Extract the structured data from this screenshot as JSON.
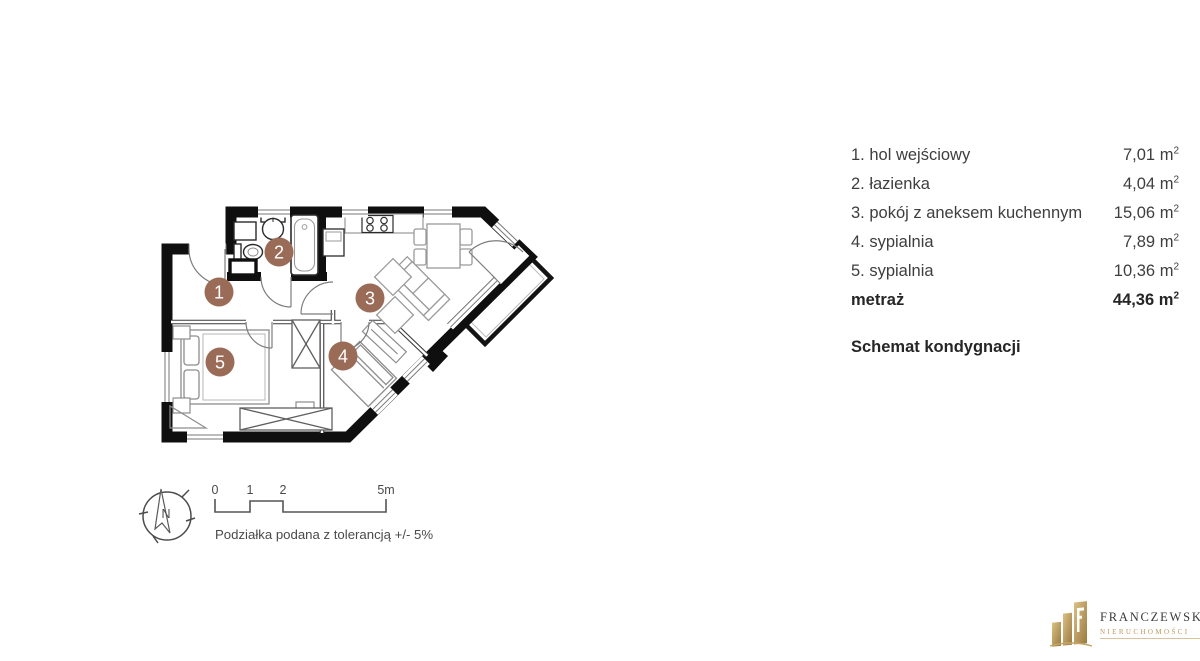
{
  "legend": {
    "rows": [
      {
        "label": "1. hol wejściowy",
        "area": "7,01"
      },
      {
        "label": "2. łazienka",
        "area": "4,04"
      },
      {
        "label": "3. pokój z aneksem kuchennym",
        "area": "15,06"
      },
      {
        "label": "4. sypialnia",
        "area": "7,89"
      },
      {
        "label": "5. sypialnia",
        "area": "10,36"
      }
    ],
    "unit": "m",
    "unit_sup": "2",
    "total": {
      "label": "metraż",
      "area": "44,36"
    },
    "schema_heading": "Schemat kondygnacji"
  },
  "plan": {
    "rooms": [
      "1",
      "2",
      "3",
      "4",
      "5"
    ],
    "marker_color": "#9a6c58",
    "wall_color": "#0f0f0f"
  },
  "compass": {
    "north_label": "N"
  },
  "scalebar": {
    "tick0": "0",
    "tick1": "1",
    "tick2": "2",
    "tick5": "5m",
    "note": "Podziałka podana z tolerancją +/- 5%"
  },
  "logo": {
    "name": "FRANCZEWSKA",
    "subtitle": "NIERUCHOMOŚCI"
  }
}
